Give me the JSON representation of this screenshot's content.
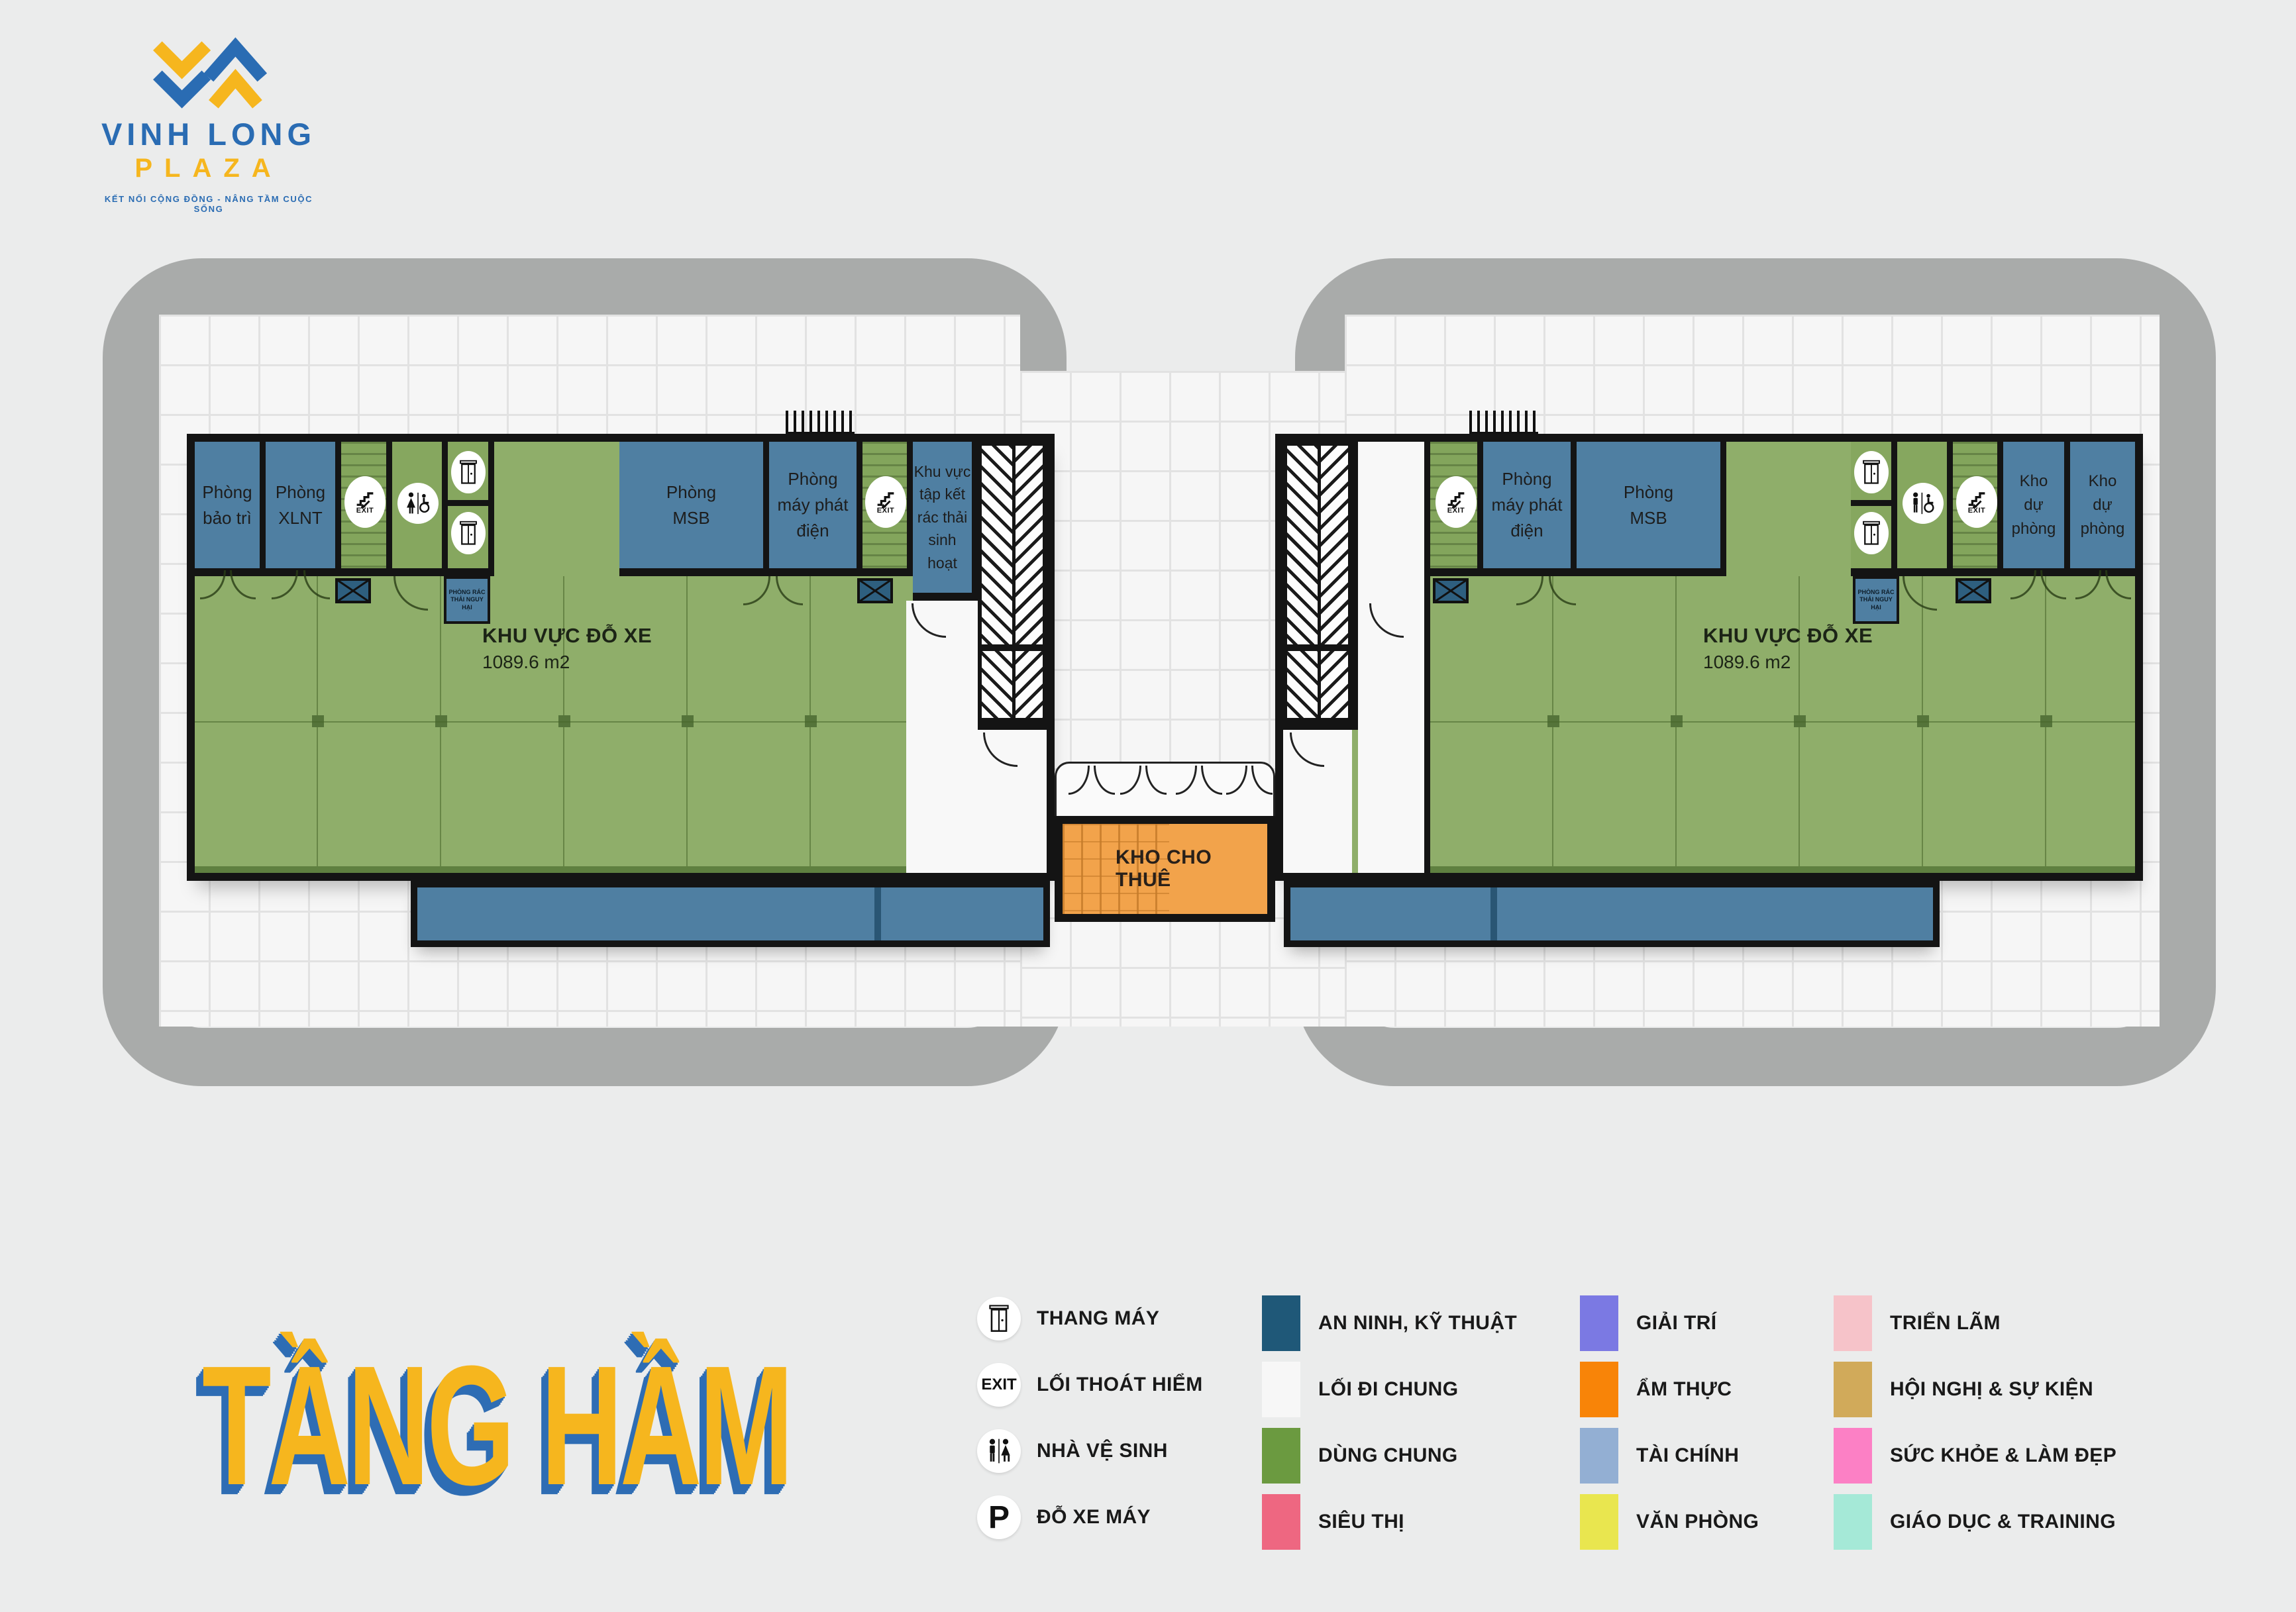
{
  "brand": {
    "name": "VINH LONG",
    "sub": "PLAZA",
    "tagline": "KẾT NỐI CỘNG ĐỒNG - NÂNG TẦM CUỘC SỐNG"
  },
  "page_title": "TẦNG HẦM",
  "rooms": {
    "bao_tri": "Phòng bảo trì",
    "xlnt": "Phòng XLNT",
    "msb": "Phòng MSB",
    "phat_dien": "Phòng máy phát điện",
    "tap_ket": "Khu vực tập kết rác thải sinh hoạt",
    "rac_thai": "PHÒNG RÁC THẢI NGUY HẠI",
    "kho_du_phong": "Kho dự phòng",
    "kho_cho_thue": "KHO CHO THUÊ",
    "parking_title": "KHU VỰC ĐỖ XE",
    "parking_area": "1089.6 m2",
    "exit": "EXIT"
  },
  "legend_icons": [
    {
      "icon": "elevator-icon",
      "label": "THANG MÁY"
    },
    {
      "icon": "exit-icon",
      "label": "LỐI THOÁT HIỂM"
    },
    {
      "icon": "wc-icon",
      "label": "NHÀ VỆ SINH"
    },
    {
      "icon": "motorbike-parking-icon",
      "label": "ĐỖ XE MÁY"
    }
  ],
  "legend_colors": [
    {
      "label": "AN NINH, KỸ THUẬT",
      "color": "#1f5878"
    },
    {
      "label": "LỐI ĐI CHUNG",
      "color": "#f7f7f7"
    },
    {
      "label": "DÙNG CHUNG",
      "color": "#6b9a40"
    },
    {
      "label": "SIÊU THỊ",
      "color": "#ee6781"
    },
    {
      "label": "GIẢI TRÍ",
      "color": "#7b79e3"
    },
    {
      "label": "ẨM THỰC",
      "color": "#f88408"
    },
    {
      "label": "TÀI CHÍNH",
      "color": "#93afd3"
    },
    {
      "label": "VĂN PHÒNG",
      "color": "#e9e64f"
    },
    {
      "label": "TRIỂN LÃM",
      "color": "#f6c3c9"
    },
    {
      "label": "HỘI NGHỊ & SỰ KIỆN",
      "color": "#d1aa5a"
    },
    {
      "label": "SỨC KHỎE & LÀM ĐẸP",
      "color": "#fc80c5"
    },
    {
      "label": "GIÁO DỤC & TRAINING",
      "color": "#a5e9d7"
    }
  ],
  "palette": {
    "room_blue": "#4f7fa2",
    "shared_green": "#8fae6a",
    "wall_black": "#141414",
    "storage_orange": "#f2a34b",
    "outline_gray": "#a9abaa",
    "brand_blue": "#2a6cb3",
    "brand_yellow": "#f6b61e"
  }
}
